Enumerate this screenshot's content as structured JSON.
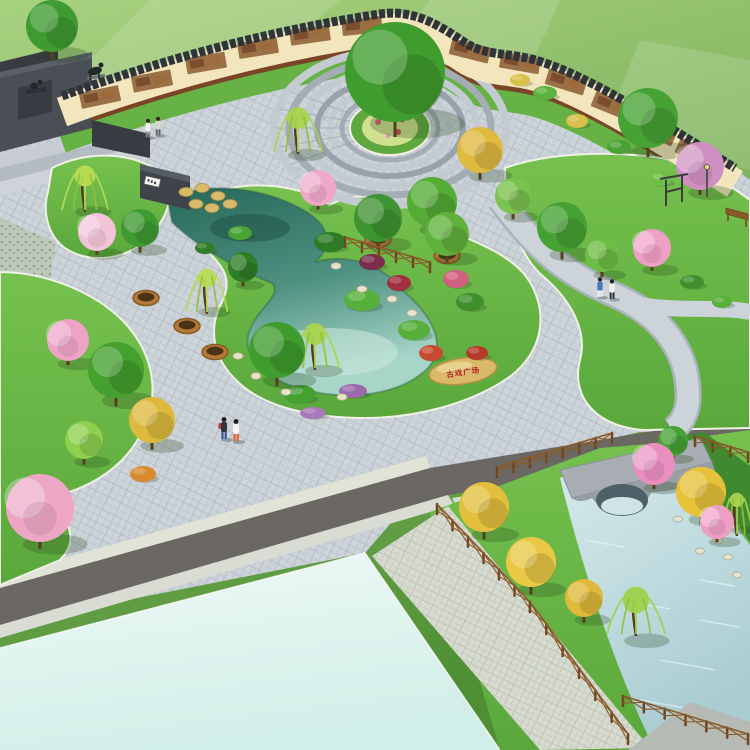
{
  "meta": {
    "scene_type": "landscape-architecture-aerial-render"
  },
  "inscriptions": {
    "stone_text": "古戏广场",
    "plaque_glyph_count": 3
  },
  "palette": {
    "field_top": "#a8d180",
    "field_bottom": "#4e8f33",
    "paving": "#ccd3d9",
    "paving_line": "#b6bec6",
    "walkway": "#d6dacf",
    "walkway_line": "#c0c5b8",
    "road": "#6b6763",
    "sidewalk": "#e0e3d6",
    "sidewalk2": "#d8dcd2",
    "plot_light": "#effaf7",
    "plot_dark": "#d2eee8",
    "lawn": "#5aa83c",
    "lawn_light": "#76c14e",
    "lawn_dark": "#3f8a2e",
    "curb": "#f0f1e6",
    "wall_face": "#f4e6bc",
    "wall_coping": "#2f333a",
    "mulch": "#7a4426",
    "mural": "#8a5a33",
    "pond_deep": "#27695a",
    "pond_mid": "#4e9180",
    "pond_light": "#a7d6c9",
    "canal_light": "#d7eaec",
    "canal_mid": "#aacdd2",
    "bridge": "#a7adb2",
    "bridge_side": "#989fa4",
    "arch": "#4f6168",
    "monument": "#4a4f55",
    "monument_dark": "#383c42",
    "monument_light": "#5a6069",
    "step1": "#c6ccd2",
    "step2": "#b4bbc2",
    "step3": "#cdd3d8",
    "fence": "#8a5a2b",
    "fence_dark": "#6f4520",
    "planter": "#b5793a",
    "planter_dark": "#8a5a26",
    "soil": "#4a3317",
    "trunk": "#5a3c1e",
    "rock": "#d9b96a",
    "rock_dark": "#b99042",
    "rock_pale": "#e9e2cd",
    "stone_text_color": "#b4232a",
    "pebble": "#bfc9bb",
    "darkpath": "#6f787f",
    "sign_wall": "#3f444a",
    "sign_wall_top": "#565c64",
    "plaque": "#f2f2ee",
    "ring_a": "#c3cbd1",
    "ring_b": "#a4adb5",
    "ring_c": "#98a2aa",
    "bed_green": "#5fa83d",
    "bed_flower": "#cfe08e",
    "statue": "#23272b",
    "metal": "#3a3f3a",
    "lamp": "#e8d88a",
    "wood": "#8a5a2b"
  },
  "scene": {
    "trees": [
      {
        "x": 52,
        "y": 26,
        "r": 26,
        "type": "round",
        "c": "#3f9a31"
      },
      {
        "x": 648,
        "y": 118,
        "r": 30,
        "type": "round",
        "c": "#46a233"
      },
      {
        "x": 700,
        "y": 166,
        "r": 24,
        "type": "blossom",
        "c": "#cf8fc0"
      },
      {
        "x": 395,
        "y": 72,
        "r": 50,
        "type": "round",
        "c": "#3f9c2e"
      },
      {
        "x": 298,
        "y": 132,
        "r": 20,
        "type": "willow",
        "c": "#a9d44e"
      },
      {
        "x": 318,
        "y": 188,
        "r": 18,
        "type": "blossom",
        "c": "#f0a8c8"
      },
      {
        "x": 480,
        "y": 150,
        "r": 23,
        "type": "round",
        "c": "#e0b93f"
      },
      {
        "x": 432,
        "y": 202,
        "r": 25,
        "type": "round",
        "c": "#54ab36"
      },
      {
        "x": 378,
        "y": 218,
        "r": 24,
        "type": "round",
        "c": "#3e9431"
      },
      {
        "x": 447,
        "y": 234,
        "r": 22,
        "type": "round",
        "c": "#61b23c"
      },
      {
        "x": 513,
        "y": 196,
        "r": 18,
        "type": "round",
        "c": "#7cc24f"
      },
      {
        "x": 85,
        "y": 190,
        "r": 19,
        "type": "willow",
        "c": "#b8dc55"
      },
      {
        "x": 97,
        "y": 232,
        "r": 19,
        "type": "blossom",
        "c": "#f3c4d8"
      },
      {
        "x": 140,
        "y": 228,
        "r": 19,
        "type": "round",
        "c": "#3f9a31"
      },
      {
        "x": 68,
        "y": 340,
        "r": 21,
        "type": "blossom",
        "c": "#eda3c6"
      },
      {
        "x": 116,
        "y": 370,
        "r": 28,
        "type": "round",
        "c": "#44a02f"
      },
      {
        "x": 152,
        "y": 420,
        "r": 23,
        "type": "round",
        "c": "#ddba3e"
      },
      {
        "x": 84,
        "y": 440,
        "r": 19,
        "type": "round",
        "c": "#8fd14f"
      },
      {
        "x": 40,
        "y": 508,
        "r": 34,
        "type": "blossom",
        "c": "#eda6c4"
      },
      {
        "x": 277,
        "y": 350,
        "r": 28,
        "type": "round",
        "c": "#3f9c2e"
      },
      {
        "x": 315,
        "y": 348,
        "r": 20,
        "type": "willow",
        "c": "#a9d44e"
      },
      {
        "x": 207,
        "y": 292,
        "r": 17,
        "type": "willow",
        "c": "#b8dc55"
      },
      {
        "x": 243,
        "y": 267,
        "r": 15,
        "type": "round",
        "c": "#2f7d26"
      },
      {
        "x": 562,
        "y": 227,
        "r": 25,
        "type": "round",
        "c": "#46a133"
      },
      {
        "x": 602,
        "y": 255,
        "r": 17,
        "type": "round",
        "c": "#6ebd45"
      },
      {
        "x": 652,
        "y": 248,
        "r": 19,
        "type": "blossom",
        "c": "#ef9fc4"
      },
      {
        "x": 484,
        "y": 507,
        "r": 25,
        "type": "round",
        "c": "#e3bf3d"
      },
      {
        "x": 531,
        "y": 562,
        "r": 25,
        "type": "round",
        "c": "#e8c845"
      },
      {
        "x": 584,
        "y": 598,
        "r": 19,
        "type": "round",
        "c": "#dfb93a"
      },
      {
        "x": 654,
        "y": 464,
        "r": 21,
        "type": "blossom",
        "c": "#e98fc0"
      },
      {
        "x": 701,
        "y": 492,
        "r": 25,
        "type": "round",
        "c": "#e6c23a"
      },
      {
        "x": 717,
        "y": 522,
        "r": 17,
        "type": "blossom",
        "c": "#ef9fc4"
      },
      {
        "x": 636,
        "y": 614,
        "r": 24,
        "type": "willow",
        "c": "#9fd14a"
      },
      {
        "x": 737,
        "y": 514,
        "r": 13,
        "type": "willow",
        "c": "#a9d44e"
      },
      {
        "x": 673,
        "y": 441,
        "r": 15,
        "type": "round",
        "c": "#46a233"
      }
    ],
    "shrubs": [
      {
        "x": 330,
        "y": 242,
        "rx": 16,
        "ry": 10,
        "c": "#2e7d26"
      },
      {
        "x": 362,
        "y": 300,
        "rx": 18,
        "ry": 11,
        "c": "#57b03a"
      },
      {
        "x": 300,
        "y": 394,
        "rx": 16,
        "ry": 9,
        "c": "#46a133"
      },
      {
        "x": 414,
        "y": 330,
        "rx": 16,
        "ry": 10,
        "c": "#57b03a"
      },
      {
        "x": 470,
        "y": 302,
        "rx": 14,
        "ry": 9,
        "c": "#3f8f2d"
      },
      {
        "x": 372,
        "y": 262,
        "rx": 13,
        "ry": 8,
        "c": "#7c2d4e"
      },
      {
        "x": 399,
        "y": 283,
        "rx": 12,
        "ry": 8,
        "c": "#a03040"
      },
      {
        "x": 456,
        "y": 279,
        "rx": 13,
        "ry": 9,
        "c": "#d06080"
      },
      {
        "x": 431,
        "y": 353,
        "rx": 12,
        "ry": 8,
        "c": "#c84a32"
      },
      {
        "x": 477,
        "y": 353,
        "rx": 11,
        "ry": 7,
        "c": "#b43a2a"
      },
      {
        "x": 353,
        "y": 391,
        "rx": 14,
        "ry": 7,
        "c": "#9a6aaa"
      },
      {
        "x": 313,
        "y": 413,
        "rx": 13,
        "ry": 6,
        "c": "#a878b8"
      },
      {
        "x": 143,
        "y": 474,
        "rx": 13,
        "ry": 8,
        "c": "#d98a2f"
      },
      {
        "x": 545,
        "y": 93,
        "rx": 12,
        "ry": 7,
        "c": "#5cb23e"
      },
      {
        "x": 577,
        "y": 121,
        "rx": 11,
        "ry": 7,
        "c": "#d8c04a"
      },
      {
        "x": 619,
        "y": 147,
        "rx": 12,
        "ry": 7,
        "c": "#4aa234"
      },
      {
        "x": 661,
        "y": 179,
        "rx": 11,
        "ry": 7,
        "c": "#6ebd45"
      },
      {
        "x": 520,
        "y": 80,
        "rx": 10,
        "ry": 6,
        "c": "#d8c04a"
      },
      {
        "x": 692,
        "y": 282,
        "rx": 12,
        "ry": 7,
        "c": "#3f8f2d"
      },
      {
        "x": 722,
        "y": 302,
        "rx": 10,
        "ry": 6,
        "c": "#57b03a"
      },
      {
        "x": 240,
        "y": 233,
        "rx": 12,
        "ry": 7,
        "c": "#4aa234"
      },
      {
        "x": 205,
        "y": 248,
        "rx": 10,
        "ry": 6,
        "c": "#2f7d26"
      }
    ],
    "planters": [
      [
        378,
        240
      ],
      [
        447,
        256
      ],
      [
        146,
        298
      ],
      [
        187,
        326
      ],
      [
        215,
        352
      ]
    ],
    "rocks_pond": [
      [
        256,
        376
      ],
      [
        286,
        392
      ],
      [
        342,
        397
      ],
      [
        392,
        299
      ],
      [
        362,
        289
      ],
      [
        412,
        313
      ],
      [
        238,
        356
      ],
      [
        336,
        266
      ]
    ],
    "rocks_canal": [
      [
        662,
        477
      ],
      [
        688,
        501
      ],
      [
        708,
        529
      ],
      [
        728,
        557
      ],
      [
        678,
        519
      ],
      [
        700,
        551
      ],
      [
        737,
        575
      ],
      [
        718,
        541
      ]
    ],
    "rocks_rockery": [
      [
        186,
        192
      ],
      [
        202,
        188
      ],
      [
        218,
        196
      ],
      [
        230,
        204
      ],
      [
        196,
        204
      ],
      [
        212,
        208
      ]
    ],
    "murals": [
      [
        100,
        97,
        -12
      ],
      [
        152,
        81,
        -11
      ],
      [
        206,
        63,
        -10
      ],
      [
        258,
        48,
        -9
      ],
      [
        310,
        35,
        -8
      ],
      [
        362,
        26,
        -6
      ],
      [
        470,
        51,
        14
      ],
      [
        520,
        63,
        10
      ],
      [
        566,
        82,
        17
      ],
      [
        612,
        106,
        22
      ],
      [
        656,
        131,
        24
      ],
      [
        696,
        153,
        24
      ]
    ],
    "fences": [
      {
        "x1": 345,
        "y1": 247,
        "x2": 430,
        "y2": 272,
        "n": 6
      },
      {
        "x1": 437,
        "y1": 514,
        "x2": 530,
        "y2": 612,
        "n": 7
      },
      {
        "x1": 530,
        "y1": 612,
        "x2": 628,
        "y2": 744,
        "n": 7
      },
      {
        "x1": 623,
        "y1": 706,
        "x2": 748,
        "y2": 744,
        "n": 7
      },
      {
        "x1": 497,
        "y1": 477,
        "x2": 612,
        "y2": 443,
        "n": 8
      },
      {
        "x1": 695,
        "y1": 446,
        "x2": 748,
        "y2": 462,
        "n": 4
      }
    ],
    "people": [
      {
        "x": 148,
        "y": 128,
        "shirt": "#f2f2f2",
        "pants": "#8a8f96",
        "hair": "#2c2c2c",
        "s": 0.85
      },
      {
        "x": 158,
        "y": 126,
        "shirt": "#dcd8cc",
        "pants": "#5b6066",
        "hair": "#2c2c2c",
        "s": 0.85
      },
      {
        "x": 224,
        "y": 428,
        "shirt": "#2e3440",
        "pants": "#3a5b8c",
        "hair": "#1d1d1d",
        "pack": "#c0392b",
        "s": 1
      },
      {
        "x": 236,
        "y": 430,
        "shirt": "#f5f5f5",
        "pants": "#e06030",
        "hair": "#1d1d1d",
        "s": 1
      },
      {
        "x": 600,
        "y": 287,
        "shirt": "#4a7ab8",
        "pants": "#f0f0f0",
        "hair": "#222222",
        "s": 0.9
      },
      {
        "x": 612,
        "y": 289,
        "shirt": "#f0f0f0",
        "pants": "#333333",
        "hair": "#222222",
        "s": 0.9
      }
    ],
    "ripples": [
      [
        585,
        540,
        40
      ],
      [
        620,
        600,
        50
      ],
      [
        660,
        660,
        55
      ],
      [
        700,
        620,
        40
      ],
      [
        640,
        700,
        60
      ],
      [
        700,
        580,
        35
      ]
    ],
    "fan_angles": [
      150,
      165,
      180,
      195,
      210
    ]
  }
}
